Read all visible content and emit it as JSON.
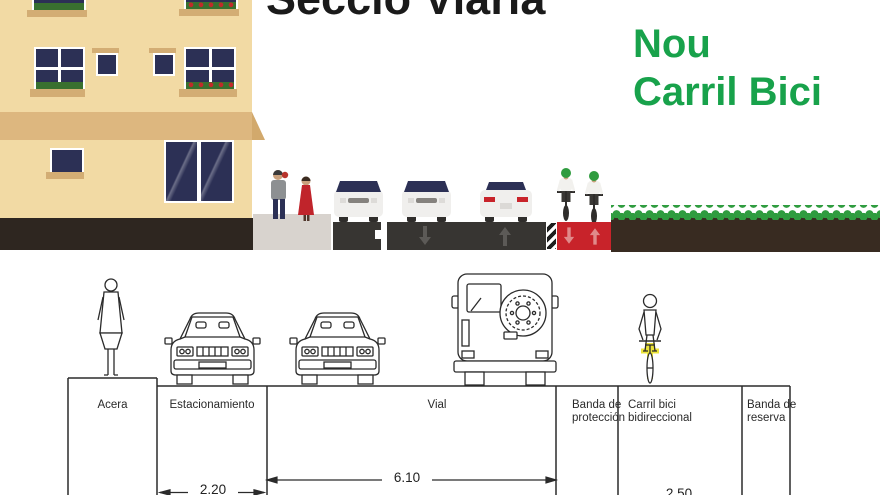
{
  "header": {
    "title": "Secció Viària",
    "subtitle_line1": "Nou",
    "subtitle_line2": "Carril Bici"
  },
  "colors": {
    "title_text": "#1a1a1a",
    "subtitle_green": "#18a24b",
    "building_beige": "#f2daa4",
    "awning_tan": "#ddb77f",
    "window_navy": "#2c3055",
    "sidewalk_gray": "#d8d3ce",
    "asphalt_dark": "#373532",
    "bike_lane_red": "#c8232a",
    "grass_green": "#2f9c3f",
    "soil_brown": "#382b21",
    "drawing_line": "#2b2b2b"
  },
  "cross_section": {
    "labels": {
      "acera": "Acera",
      "estacionamiento": "Estacionamiento",
      "vial": "Vial",
      "banda_proteccion_line1": "Banda de",
      "banda_proteccion_line2": "protección",
      "carril_bici_line1": "Carril bici",
      "carril_bici_line2": "bidireccional",
      "banda_reserva_line1": "Banda de",
      "banda_reserva_line2": "reserva"
    },
    "dimensions": {
      "estacionamiento_width": "2.20",
      "vial_width": "6.10",
      "carril_bici_width": "2.50"
    }
  }
}
